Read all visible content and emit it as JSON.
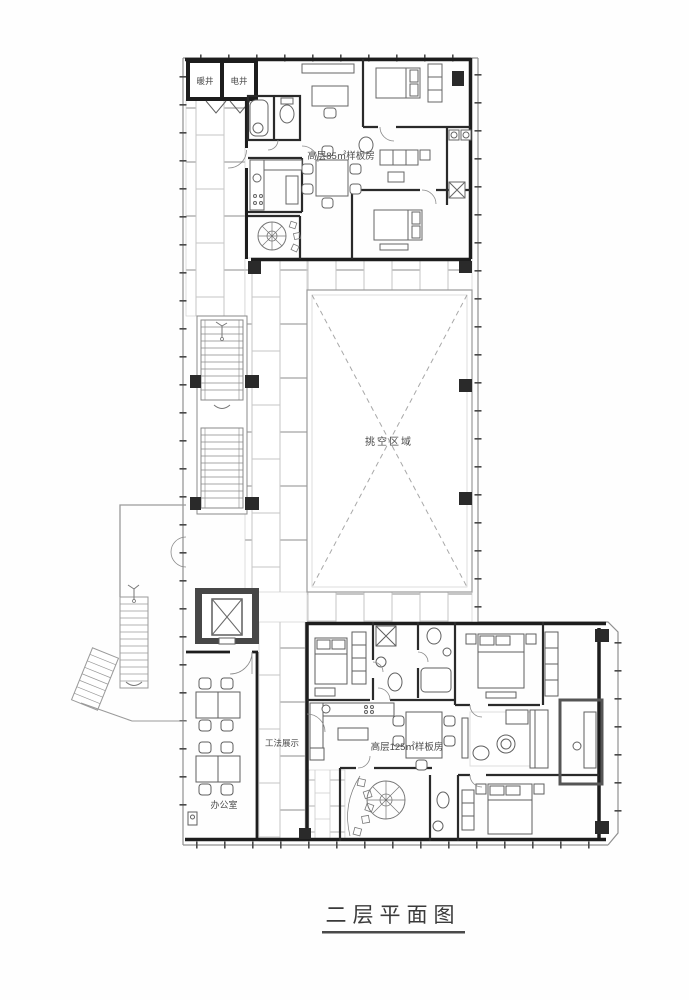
{
  "title": {
    "text": "二层平面图"
  },
  "plan": {
    "shafts": {
      "left": "暖井",
      "right": "电井"
    },
    "labels": {
      "model_85": "高层85㎡样板房",
      "void_area": "挑空区域",
      "construction_display": "工法展示",
      "office": "办公室",
      "model_125": "高层125㎡样板房"
    },
    "colors": {
      "wall": "#1d1d1d",
      "boundary": "#8f8f8f",
      "tile_line": "#c6c6c6",
      "furniture_line": "#5f5f5f",
      "text": "#4a4a4a",
      "dash": "#9a9a9a"
    }
  }
}
